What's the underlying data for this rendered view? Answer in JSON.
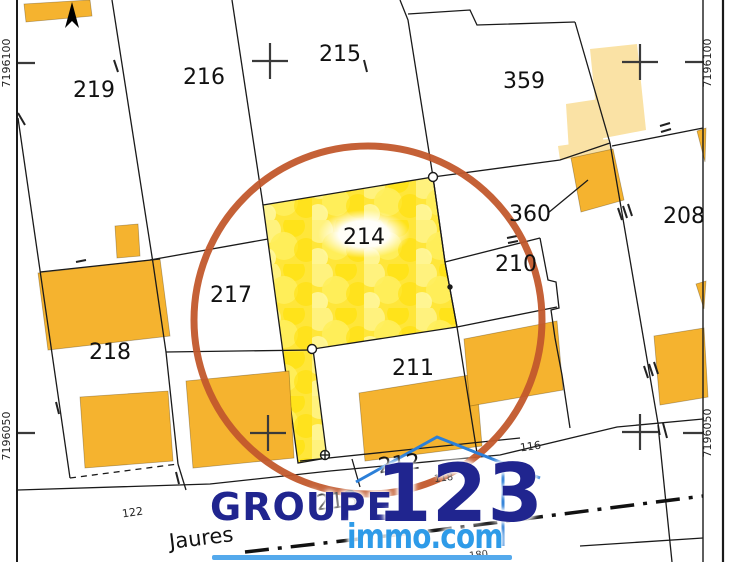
{
  "map": {
    "parcels": [
      {
        "label": "219"
      },
      {
        "label": "216"
      },
      {
        "label": "215"
      },
      {
        "label": "359"
      },
      {
        "label": "360"
      },
      {
        "label": "208"
      },
      {
        "label": "210"
      },
      {
        "label": "217"
      },
      {
        "label": "214"
      },
      {
        "label": "218"
      },
      {
        "label": "211"
      },
      {
        "label": "212"
      },
      {
        "label": "213"
      }
    ],
    "coordinate_labels": {
      "left_top": "7196100",
      "left_bottom": "7196050",
      "right_top": "7196100",
      "right_bottom": "7196050"
    },
    "street_name": "Jaures",
    "small_numbers": [
      {
        "label": "122"
      },
      {
        "label": "116"
      },
      {
        "label": "118"
      },
      {
        "label": "180"
      }
    ],
    "highlight": {
      "highlighted_parcel": "214",
      "circle_color": "#C2592C",
      "parcel_fill_color": "#FFE63A"
    },
    "colors": {
      "building": "#F5B32F",
      "building_light": "#FAE2A5",
      "boundary_line": "#1A1A1A"
    }
  },
  "watermark": {
    "groupe": "GROUPE",
    "number": "123",
    "domain": "immo.com",
    "navy": "#20258F",
    "blue": "#2E9BE8"
  }
}
